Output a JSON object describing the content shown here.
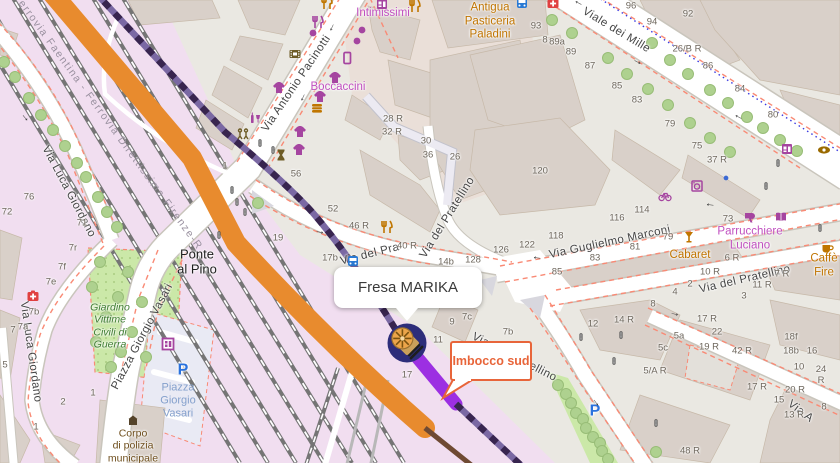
{
  "map": {
    "popup": {
      "title": "Fresa MARIKA"
    },
    "callout": {
      "label": "Imbocco sud"
    },
    "colors": {
      "orange_route": "#e88b2e",
      "brown_route": "#6f4a33",
      "purple_route_bright": "#9c2fe2",
      "purple_route_dashed": "#38254f",
      "marker_bg": "#2d2d7a",
      "marker_icon": "#eca54a",
      "callout_orange": "#e8653a",
      "popup_text": "#3a3a3a",
      "shop_magenta": "#c050c0",
      "food_orange": "#c07400",
      "park_green": "#cbe8a8",
      "railway_pink": "#f1def0",
      "road_white": "#ffffff",
      "building_tan": "#d9d0c9",
      "footway_red": "#f98a75",
      "cycleway_blue": "#3a3ae0"
    },
    "street_labels": [
      {
        "text": "Via Antonio Pacinotti",
        "x": 297,
        "y": 84,
        "rot": -56,
        "cls": "street"
      },
      {
        "text": "Viale dei Mille",
        "x": 616,
        "y": 31,
        "rot": 31,
        "cls": "street"
      },
      {
        "text": "Via Guglielmo Marconi",
        "x": 610,
        "y": 243,
        "rot": -12,
        "cls": "street"
      },
      {
        "text": "Via del Pra",
        "x": 370,
        "y": 255,
        "rot": -14,
        "cls": "street"
      },
      {
        "text": "Via del Pratellino",
        "x": 448,
        "y": 218,
        "rot": -58,
        "cls": "street"
      },
      {
        "text": "Via del Pratellino",
        "x": 745,
        "y": 280,
        "rot": -13,
        "cls": "street"
      },
      {
        "text": "Via del Pratellino",
        "x": 514,
        "y": 358,
        "rot": 27,
        "cls": "street"
      },
      {
        "text": "Via A",
        "x": 800,
        "y": 412,
        "rot": 37,
        "cls": "street"
      },
      {
        "text": "Via Luca Giordano",
        "x": 68,
        "y": 192,
        "rot": 62,
        "cls": "street"
      },
      {
        "text": "Via Luca Giordano",
        "x": 30,
        "y": 352,
        "rot": 82,
        "cls": "street"
      },
      {
        "text": "Piazza Giorgio Vasari",
        "x": 143,
        "y": 337,
        "rot": -62,
        "cls": "street"
      },
      {
        "text": "Ferrovia Faentina - Ferrovia Direttissima Firenze-R",
        "x": 108,
        "y": 122,
        "rot": 54,
        "cls": "rail-label"
      }
    ],
    "place_labels": [
      {
        "text": "Ponte\nal Pino",
        "x": 197,
        "y": 262,
        "cls": "place"
      },
      {
        "text": "Intimissimi",
        "x": 383,
        "y": 14,
        "cls": "poi-magenta"
      },
      {
        "text": "Boccaccini",
        "x": 338,
        "y": 88,
        "cls": "poi-magenta"
      },
      {
        "text": "Antigua\nPasticeria\nPaladini",
        "x": 490,
        "y": 22,
        "cls": "poi-orange"
      },
      {
        "text": "Parrucchiere\nLuciano",
        "x": 750,
        "y": 239,
        "cls": "poi-magenta"
      },
      {
        "text": "Cabaret",
        "x": 690,
        "y": 256,
        "cls": "poi-orange"
      },
      {
        "text": "Caffè Fire",
        "x": 824,
        "y": 266,
        "cls": "poi-orange"
      },
      {
        "text": "Giardino\nVittime\nCivili di\nGuerra",
        "x": 110,
        "y": 326,
        "cls": "park-label"
      },
      {
        "text": "Piazza\nGiorgio\nVasari",
        "x": 178,
        "y": 401,
        "cls": "parking-label"
      },
      {
        "text": "P",
        "x": 183,
        "y": 371,
        "cls": "parking-p"
      },
      {
        "text": "P",
        "x": 595,
        "y": 412,
        "cls": "parking-p"
      },
      {
        "text": "Corpo\ndi polizia\nmunicipale",
        "x": 133,
        "y": 446,
        "cls": "police-label"
      }
    ],
    "house_numbers": [
      {
        "text": "28 R",
        "x": 393,
        "y": 119
      },
      {
        "text": "32 R",
        "x": 392,
        "y": 132
      },
      {
        "text": "30",
        "x": 426,
        "y": 141
      },
      {
        "text": "36",
        "x": 428,
        "y": 155
      },
      {
        "text": "26",
        "x": 455,
        "y": 157
      },
      {
        "text": "56",
        "x": 296,
        "y": 174
      },
      {
        "text": "52",
        "x": 333,
        "y": 209
      },
      {
        "text": "46 R",
        "x": 359,
        "y": 226
      },
      {
        "text": "40 R",
        "x": 407,
        "y": 246
      },
      {
        "text": "19",
        "x": 278,
        "y": 238
      },
      {
        "text": "17b",
        "x": 330,
        "y": 258
      },
      {
        "text": "14b",
        "x": 446,
        "y": 262
      },
      {
        "text": "128",
        "x": 473,
        "y": 260
      },
      {
        "text": "126",
        "x": 501,
        "y": 250
      },
      {
        "text": "122",
        "x": 527,
        "y": 245
      },
      {
        "text": "118",
        "x": 556,
        "y": 236
      },
      {
        "text": "116",
        "x": 617,
        "y": 218
      },
      {
        "text": "114",
        "x": 642,
        "y": 210
      },
      {
        "text": "120",
        "x": 540,
        "y": 171
      },
      {
        "text": "37 R",
        "x": 717,
        "y": 160
      },
      {
        "text": "9",
        "x": 452,
        "y": 322
      },
      {
        "text": "7c",
        "x": 467,
        "y": 317
      },
      {
        "text": "11",
        "x": 438,
        "y": 340
      },
      {
        "text": "7b",
        "x": 508,
        "y": 332
      },
      {
        "text": "17",
        "x": 407,
        "y": 375
      },
      {
        "text": "96",
        "x": 631,
        "y": 6
      },
      {
        "text": "94",
        "x": 652,
        "y": 22
      },
      {
        "text": "92",
        "x": 688,
        "y": 14
      },
      {
        "text": "8",
        "x": 545,
        "y": 40
      },
      {
        "text": "93",
        "x": 536,
        "y": 26
      },
      {
        "text": "89a",
        "x": 557,
        "y": 42
      },
      {
        "text": "89",
        "x": 571,
        "y": 52
      },
      {
        "text": "87",
        "x": 590,
        "y": 66
      },
      {
        "text": "85",
        "x": 617,
        "y": 86
      },
      {
        "text": "83",
        "x": 637,
        "y": 100
      },
      {
        "text": "26/B R",
        "x": 687,
        "y": 49
      },
      {
        "text": "86",
        "x": 708,
        "y": 66
      },
      {
        "text": "84",
        "x": 740,
        "y": 89
      },
      {
        "text": "80",
        "x": 773,
        "y": 115
      },
      {
        "text": "79",
        "x": 670,
        "y": 124
      },
      {
        "text": "75",
        "x": 697,
        "y": 146
      },
      {
        "text": "73",
        "x": 728,
        "y": 219
      },
      {
        "text": "79",
        "x": 668,
        "y": 237
      },
      {
        "text": "81",
        "x": 635,
        "y": 247
      },
      {
        "text": "83",
        "x": 595,
        "y": 258
      },
      {
        "text": "85",
        "x": 557,
        "y": 272
      },
      {
        "text": "6 R",
        "x": 732,
        "y": 258
      },
      {
        "text": "10 R",
        "x": 710,
        "y": 272
      },
      {
        "text": "2",
        "x": 690,
        "y": 284
      },
      {
        "text": "4",
        "x": 675,
        "y": 292
      },
      {
        "text": "7 R",
        "x": 782,
        "y": 274
      },
      {
        "text": "11 R",
        "x": 762,
        "y": 285
      },
      {
        "text": "3",
        "x": 744,
        "y": 296
      },
      {
        "text": "12",
        "x": 593,
        "y": 324
      },
      {
        "text": "14 R",
        "x": 624,
        "y": 320
      },
      {
        "text": "8",
        "x": 653,
        "y": 304
      },
      {
        "text": "5a",
        "x": 679,
        "y": 336
      },
      {
        "text": "5c",
        "x": 663,
        "y": 348
      },
      {
        "text": "5/A R",
        "x": 655,
        "y": 371
      },
      {
        "text": "17 R",
        "x": 707,
        "y": 319
      },
      {
        "text": "22",
        "x": 717,
        "y": 332
      },
      {
        "text": "19 R",
        "x": 709,
        "y": 347
      },
      {
        "text": "42 R",
        "x": 742,
        "y": 351
      },
      {
        "text": "18f",
        "x": 791,
        "y": 337
      },
      {
        "text": "18b",
        "x": 791,
        "y": 351
      },
      {
        "text": "16",
        "x": 812,
        "y": 351
      },
      {
        "text": "10",
        "x": 799,
        "y": 367
      },
      {
        "text": "24 R",
        "x": 821,
        "y": 375
      },
      {
        "text": "17 R",
        "x": 757,
        "y": 387
      },
      {
        "text": "20 R",
        "x": 795,
        "y": 390
      },
      {
        "text": "15",
        "x": 779,
        "y": 400
      },
      {
        "text": "13 R",
        "x": 794,
        "y": 415
      },
      {
        "text": "8",
        "x": 824,
        "y": 407
      },
      {
        "text": "48 R",
        "x": 690,
        "y": 451
      },
      {
        "text": "76",
        "x": 29,
        "y": 197
      },
      {
        "text": "72",
        "x": 7,
        "y": 212
      },
      {
        "text": "71",
        "x": 82,
        "y": 223
      },
      {
        "text": "7r",
        "x": 73,
        "y": 248
      },
      {
        "text": "7f",
        "x": 62,
        "y": 267
      },
      {
        "text": "7e",
        "x": 51,
        "y": 282
      },
      {
        "text": "7b",
        "x": 34,
        "y": 312
      },
      {
        "text": "7a",
        "x": 23,
        "y": 327
      },
      {
        "text": "7",
        "x": 13,
        "y": 330
      },
      {
        "text": "5",
        "x": 5,
        "y": 365
      },
      {
        "text": "2",
        "x": 63,
        "y": 402
      },
      {
        "text": "1",
        "x": 93,
        "y": 393
      },
      {
        "text": "1",
        "x": 36,
        "y": 427
      },
      {
        "text": "1",
        "x": 225,
        "y": 166
      }
    ],
    "arrows": [
      {
        "text": "→",
        "x": 333,
        "y": 28,
        "rot": 115
      },
      {
        "text": "→",
        "x": 304,
        "y": 98,
        "rot": 115
      },
      {
        "text": "→",
        "x": 578,
        "y": 4,
        "rot": 207
      },
      {
        "text": "→",
        "x": 638,
        "y": 61,
        "rot": 27
      },
      {
        "text": "→",
        "x": 738,
        "y": 118,
        "rot": 207
      },
      {
        "text": "→",
        "x": 710,
        "y": 206,
        "rot": 187
      },
      {
        "text": "→",
        "x": 537,
        "y": 259,
        "rot": 187
      },
      {
        "text": "→",
        "x": 675,
        "y": 313,
        "rot": 12
      },
      {
        "text": "→",
        "x": 597,
        "y": 402,
        "rot": 55
      },
      {
        "text": "→",
        "x": 26,
        "y": 117,
        "rot": 50
      },
      {
        "text": "→",
        "x": 320,
        "y": 231,
        "rot": 10
      }
    ],
    "icons": [
      {
        "sym": "cutlery",
        "x": 327,
        "y": 3,
        "c": "#c07600"
      },
      {
        "sym": "shopwin",
        "x": 382,
        "y": 4,
        "c": "#a545a0"
      },
      {
        "sym": "cutlery",
        "x": 415,
        "y": 6,
        "c": "#c07600"
      },
      {
        "sym": "cutlery",
        "x": 318,
        "y": 22,
        "c": "#a545a0"
      },
      {
        "sym": "dot",
        "x": 313,
        "y": 33,
        "c": "#a545a0"
      },
      {
        "sym": "dot",
        "x": 362,
        "y": 30,
        "c": "#a545a0"
      },
      {
        "sym": "dot",
        "x": 357,
        "y": 41,
        "c": "#a545a0"
      },
      {
        "sym": "film",
        "x": 295,
        "y": 54,
        "c": "#6d5c26"
      },
      {
        "sym": "phone",
        "x": 347,
        "y": 58,
        "c": "#a545a0"
      },
      {
        "sym": "tshirt",
        "x": 335,
        "y": 78,
        "c": "#a545a0"
      },
      {
        "sym": "tshirt",
        "x": 279,
        "y": 88,
        "c": "#a545a0"
      },
      {
        "sym": "tshirt",
        "x": 320,
        "y": 97,
        "c": "#a545a0"
      },
      {
        "sym": "burger",
        "x": 317,
        "y": 108,
        "c": "#c07600"
      },
      {
        "sym": "wine",
        "x": 255,
        "y": 118,
        "c": "#a545a0"
      },
      {
        "sym": "tshirt",
        "x": 300,
        "y": 132,
        "c": "#a545a0"
      },
      {
        "sym": "playground",
        "x": 243,
        "y": 134,
        "c": "#6d5c26"
      },
      {
        "sym": "tshirt",
        "x": 299,
        "y": 150,
        "c": "#a545a0"
      },
      {
        "sym": "hourglass",
        "x": 281,
        "y": 155,
        "c": "#6d5c26"
      },
      {
        "sym": "cutlery",
        "x": 387,
        "y": 227,
        "c": "#c07600"
      },
      {
        "sym": "bus",
        "x": 353,
        "y": 261
      },
      {
        "sym": "bus",
        "x": 522,
        "y": 3
      },
      {
        "sym": "hospital",
        "x": 553,
        "y": 3
      },
      {
        "sym": "hospital",
        "x": 33,
        "y": 296
      },
      {
        "sym": "washer",
        "x": 697,
        "y": 186,
        "c": "#a545a0"
      },
      {
        "sym": "bike",
        "x": 665,
        "y": 196,
        "c": "#a545a0"
      },
      {
        "sym": "dot",
        "x": 726,
        "y": 178,
        "c": "#3b6ad4",
        "size": 0.7
      },
      {
        "sym": "dryer",
        "x": 750,
        "y": 217,
        "c": "#a545a0"
      },
      {
        "sym": "book",
        "x": 781,
        "y": 217,
        "c": "#a545a0"
      },
      {
        "sym": "cocktail",
        "x": 689,
        "y": 237,
        "c": "#c07600"
      },
      {
        "sym": "cup",
        "x": 827,
        "y": 248,
        "c": "#c07600"
      },
      {
        "sym": "shopwin",
        "x": 787,
        "y": 149,
        "c": "#a545a0"
      },
      {
        "sym": "eye",
        "x": 824,
        "y": 150,
        "c": "#9a6a00"
      },
      {
        "sym": "museum",
        "x": 168,
        "y": 344,
        "c": "#a545a0"
      },
      {
        "sym": "police",
        "x": 133,
        "y": 420,
        "c": "#55432a"
      },
      {
        "sym": "tlight",
        "x": 260,
        "y": 143,
        "size": 0.62
      },
      {
        "sym": "tlight",
        "x": 273,
        "y": 150,
        "size": 0.62
      },
      {
        "sym": "tlight",
        "x": 232,
        "y": 190,
        "size": 0.62
      },
      {
        "sym": "tlight",
        "x": 237,
        "y": 202,
        "size": 0.62
      },
      {
        "sym": "tlight",
        "x": 245,
        "y": 212,
        "size": 0.62
      },
      {
        "sym": "tlight",
        "x": 219,
        "y": 235,
        "size": 0.62
      },
      {
        "sym": "tlight",
        "x": 778,
        "y": 163,
        "size": 0.62
      },
      {
        "sym": "tlight",
        "x": 766,
        "y": 186,
        "size": 0.62
      },
      {
        "sym": "tlight",
        "x": 820,
        "y": 228,
        "size": 0.62
      },
      {
        "sym": "tlight",
        "x": 581,
        "y": 337,
        "size": 0.62
      },
      {
        "sym": "tlight",
        "x": 621,
        "y": 335,
        "size": 0.62
      },
      {
        "sym": "tlight",
        "x": 614,
        "y": 361,
        "size": 0.62
      },
      {
        "sym": "tlight",
        "x": 656,
        "y": 423,
        "size": 0.62
      }
    ],
    "trees": [
      {
        "x": 552,
        "y": 20
      },
      {
        "x": 572,
        "y": 33
      },
      {
        "x": 608,
        "y": 58
      },
      {
        "x": 627,
        "y": 74
      },
      {
        "x": 648,
        "y": 89
      },
      {
        "x": 668,
        "y": 105
      },
      {
        "x": 690,
        "y": 123
      },
      {
        "x": 710,
        "y": 138
      },
      {
        "x": 730,
        "y": 152
      },
      {
        "x": 652,
        "y": 43
      },
      {
        "x": 670,
        "y": 60
      },
      {
        "x": 688,
        "y": 74
      },
      {
        "x": 710,
        "y": 90
      },
      {
        "x": 728,
        "y": 103
      },
      {
        "x": 747,
        "y": 117
      },
      {
        "x": 763,
        "y": 128
      },
      {
        "x": 780,
        "y": 140
      },
      {
        "x": 797,
        "y": 151
      },
      {
        "x": 4,
        "y": 62
      },
      {
        "x": 15,
        "y": 77
      },
      {
        "x": 29,
        "y": 98
      },
      {
        "x": 41,
        "y": 115
      },
      {
        "x": 53,
        "y": 130
      },
      {
        "x": 65,
        "y": 146
      },
      {
        "x": 77,
        "y": 163
      },
      {
        "x": 86,
        "y": 177
      },
      {
        "x": 98,
        "y": 197
      },
      {
        "x": 107,
        "y": 212
      },
      {
        "x": 117,
        "y": 227
      },
      {
        "x": 100,
        "y": 262
      },
      {
        "x": 128,
        "y": 272
      },
      {
        "x": 92,
        "y": 287
      },
      {
        "x": 118,
        "y": 297
      },
      {
        "x": 142,
        "y": 302
      },
      {
        "x": 106,
        "y": 317
      },
      {
        "x": 132,
        "y": 332
      },
      {
        "x": 96,
        "y": 342
      },
      {
        "x": 121,
        "y": 352
      },
      {
        "x": 146,
        "y": 357
      },
      {
        "x": 111,
        "y": 367
      },
      {
        "x": 258,
        "y": 203
      },
      {
        "x": 558,
        "y": 385
      },
      {
        "x": 566,
        "y": 394
      },
      {
        "x": 571,
        "y": 403
      },
      {
        "x": 576,
        "y": 413
      },
      {
        "x": 583,
        "y": 419
      },
      {
        "x": 586,
        "y": 428
      },
      {
        "x": 593,
        "y": 437
      },
      {
        "x": 600,
        "y": 443
      },
      {
        "x": 602,
        "y": 451
      },
      {
        "x": 608,
        "y": 459
      },
      {
        "x": 656,
        "y": 452
      }
    ]
  }
}
